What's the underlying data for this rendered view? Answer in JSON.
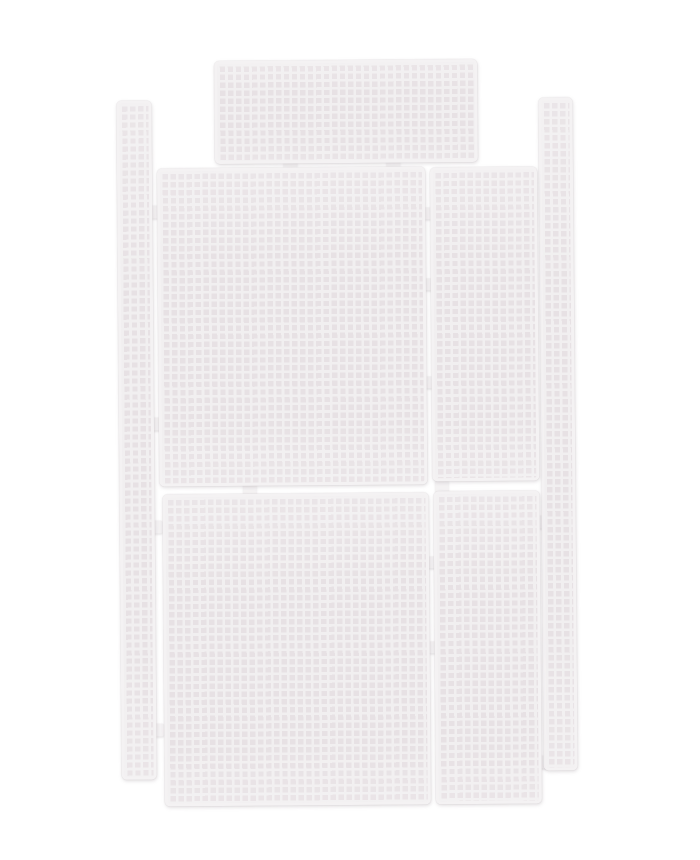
{
  "meta": {
    "description": "Product photo of seven white plastic canvas mesh craft panels laid out flat on a white background, connected by small molded tabs",
    "background_color": "#ffffff"
  },
  "mesh_style": {
    "hole_color": "#e7e1e4",
    "bar_color": "#f1eff0",
    "frame_color": "#f4f2f3",
    "shadow_color": "rgba(151,140,146,0.28)",
    "cell_pitch_px": 8,
    "bar_thickness_px": 2.6,
    "scene_rotation_deg": -0.45
  },
  "panels": [
    {
      "name": "left-side-strip",
      "x": 119,
      "y": 99,
      "w": 35,
      "h": 679
    },
    {
      "name": "right-side-strip",
      "x": 541,
      "y": 99,
      "w": 34,
      "h": 673
    },
    {
      "name": "top-panel",
      "x": 217,
      "y": 60,
      "w": 263,
      "h": 103
    },
    {
      "name": "middle-left-panel",
      "x": 159,
      "y": 167,
      "w": 268,
      "h": 318
    },
    {
      "name": "middle-right-panel",
      "x": 432,
      "y": 168,
      "w": 107,
      "h": 314
    },
    {
      "name": "bottom-left-panel",
      "x": 162,
      "y": 493,
      "w": 266,
      "h": 312
    },
    {
      "name": "bottom-right-panel",
      "x": 433,
      "y": 492,
      "w": 106,
      "h": 313
    }
  ],
  "connector_tabs": [
    {
      "x": 286,
      "y": 159,
      "w": 13,
      "h": 11
    },
    {
      "x": 389,
      "y": 159,
      "w": 13,
      "h": 11
    },
    {
      "x": 150,
      "y": 204,
      "w": 12,
      "h": 13
    },
    {
      "x": 150,
      "y": 416,
      "w": 12,
      "h": 13
    },
    {
      "x": 150,
      "y": 519,
      "w": 12,
      "h": 13
    },
    {
      "x": 150,
      "y": 722,
      "w": 12,
      "h": 13
    },
    {
      "x": 424,
      "y": 208,
      "w": 11,
      "h": 12
    },
    {
      "x": 424,
      "y": 279,
      "w": 11,
      "h": 12
    },
    {
      "x": 424,
      "y": 377,
      "w": 11,
      "h": 12
    },
    {
      "x": 243,
      "y": 482,
      "w": 13,
      "h": 13
    },
    {
      "x": 435,
      "y": 480,
      "w": 13,
      "h": 13
    },
    {
      "x": 536,
      "y": 517,
      "w": 10,
      "h": 13
    },
    {
      "x": 536,
      "y": 757,
      "w": 10,
      "h": 13
    },
    {
      "x": 426,
      "y": 557,
      "w": 10,
      "h": 12
    },
    {
      "x": 426,
      "y": 642,
      "w": 10,
      "h": 12
    }
  ]
}
